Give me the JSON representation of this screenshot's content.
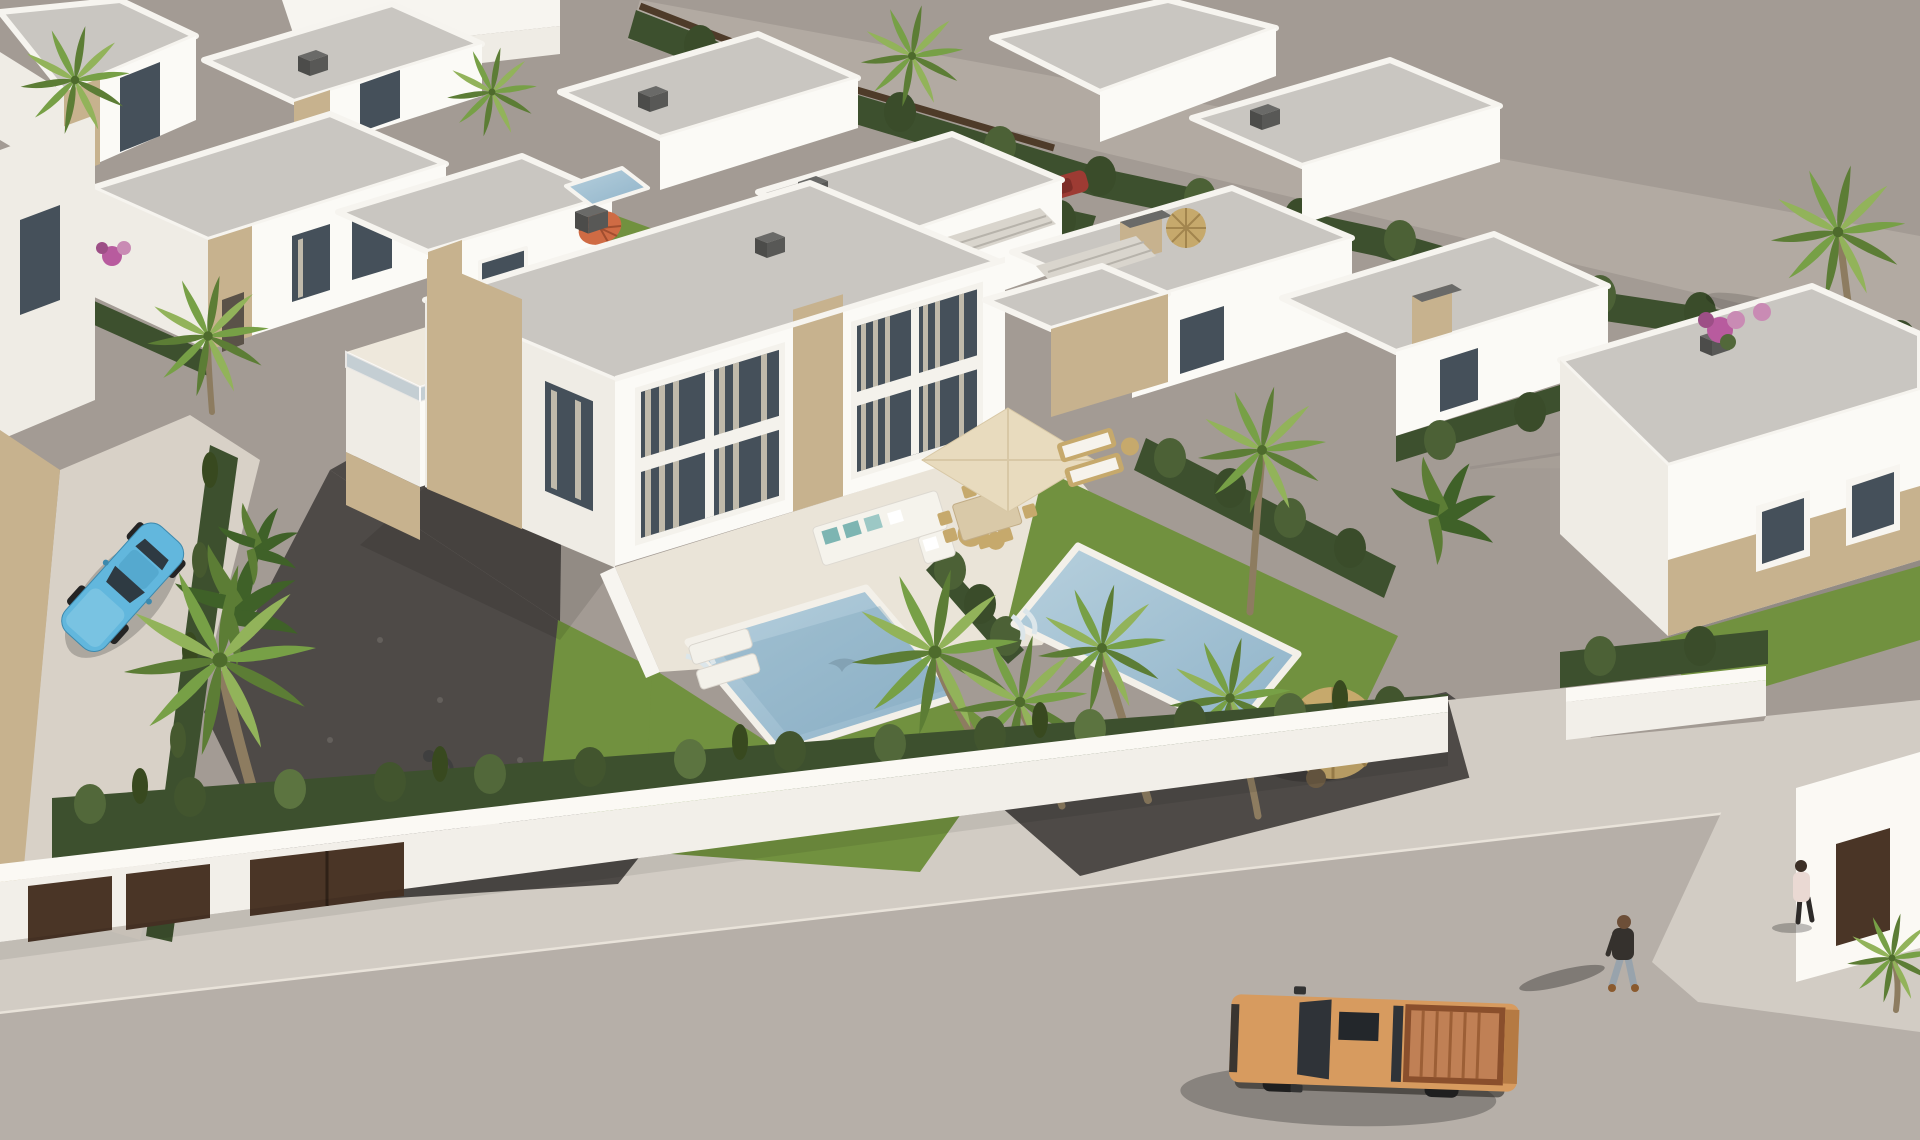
{
  "image_type": "3d-architectural-render",
  "scene": {
    "setting": "aerial bird's-eye render of a modern white villa residential development beside an empty plot, with a street along the bottom",
    "lighting": "late-afternoon sun from the right, shadows cast to the lower-left",
    "objects": [
      {
        "name": "white-flat-roof-villas",
        "count": 14
      },
      {
        "name": "central-duplex-villa-with-stone-accents",
        "count": 1
      },
      {
        "name": "swimming-pools",
        "count": 3
      },
      {
        "name": "small-background-pool",
        "count": 1
      },
      {
        "name": "palm-trees",
        "count": 12
      },
      {
        "name": "banana-plants",
        "count": 3
      },
      {
        "name": "bougainvillea-clusters",
        "count": 3
      },
      {
        "name": "cypress-hedgerows",
        "count": 9
      },
      {
        "name": "tan-pickup-truck-on-road",
        "count": 1
      },
      {
        "name": "light-blue-coupe-parked",
        "count": 1
      },
      {
        "name": "red-car-partially-hidden",
        "count": 1
      },
      {
        "name": "pedestrians",
        "count": 2
      },
      {
        "name": "straw-parasols",
        "count": 2
      },
      {
        "name": "cream-square-parasol",
        "count": 1
      },
      {
        "name": "orange-umbrella",
        "count": 1
      },
      {
        "name": "outdoor-corner-sofa-with-teal-cushions",
        "count": 1
      },
      {
        "name": "outdoor-dining-set",
        "count": 1
      },
      {
        "name": "sun-loungers",
        "count": 4
      },
      {
        "name": "street-lamp",
        "count": 1
      },
      {
        "name": "stepping-stones",
        "count": 7
      },
      {
        "name": "white-perimeter-wall-with-brown-gates",
        "count": 1
      },
      {
        "name": "gravel-driveways",
        "count": 2
      },
      {
        "name": "empty-grey-plot",
        "count": 1
      }
    ]
  },
  "palette": {
    "ground": "#a39b94",
    "ground_light": "#b2aaa2",
    "road": "#b6afa8",
    "sidewalk": "#d2ccc4",
    "path": "#d8d1c7",
    "wall_top": "#fbf9f4",
    "wall_face": "#f2efe9",
    "roof": "#c9c6c1",
    "parapet": "#f6f4ef",
    "facade_lit": "#fbfaf6",
    "facade_side": "#efece5",
    "stone": "#c7b28e",
    "glass": "#45505a",
    "curtain": "#d6ccba",
    "deck": "#eae4d8",
    "pool_light": "#b7d0dd",
    "pool_deep": "#8fb3c9",
    "grass": "#71913f",
    "grass_light": "#84a44d",
    "hedge": "#3d502e",
    "hedge_light": "#52683a",
    "gravel": "#4e4a47",
    "palm_trunk": "#8d7c60",
    "straw": "#c6a96c",
    "parasol_cream": "#e8dbbe",
    "umbrella_orange": "#cf6b44",
    "teal_cushion": "#7db5b2",
    "car_blue": "#62b7dd",
    "truck_body": "#d79b5f",
    "truck_bed": "#8a4f2c",
    "red_car": "#9d3b33",
    "door_brown": "#4a3526",
    "fence_brown": "#4e3b29",
    "flower_pink": "#b85b9e",
    "person_jacket": "#35312d",
    "person_jeans": "#98a3ac",
    "person_shirt": "#ead9d3"
  }
}
